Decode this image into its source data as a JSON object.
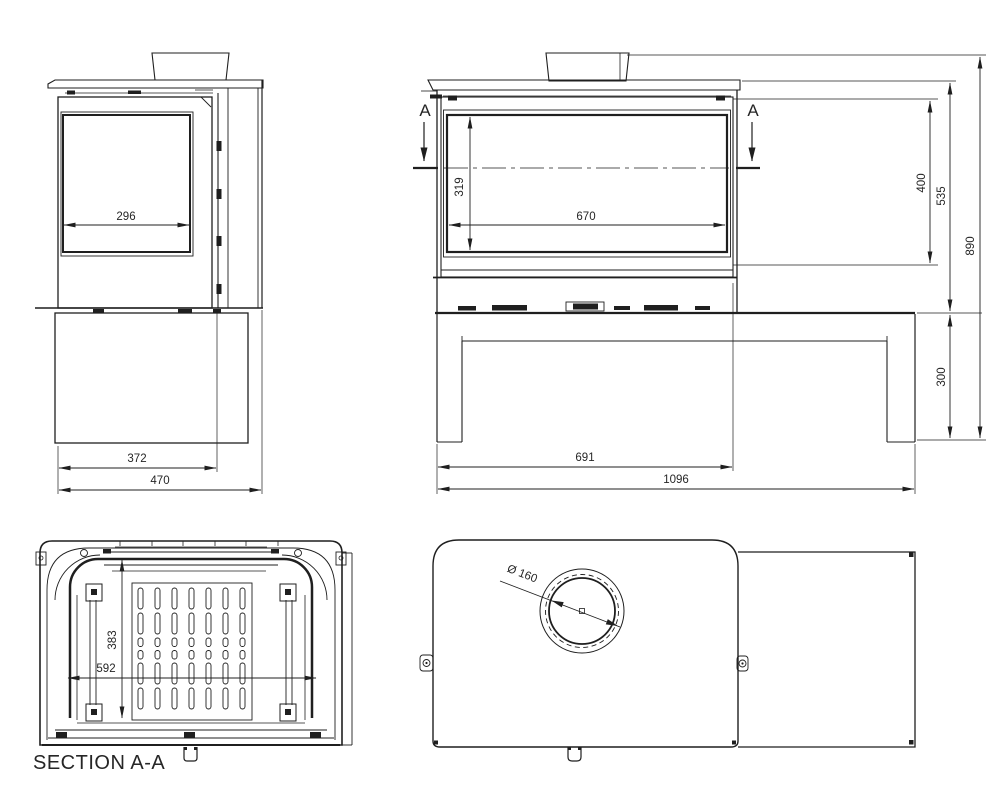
{
  "meta": {
    "background": "#ffffff",
    "ink": "#1f1f1f",
    "drawing_type": "stove technical drawing, 4 views"
  },
  "labels": {
    "section_marker": "A",
    "section_title": "SECTION A-A",
    "flue_diameter": "Ø 160"
  },
  "dimensions": {
    "side": {
      "glass_width": "296",
      "door_depth": "372",
      "total_depth": "470"
    },
    "front": {
      "glass_height": "319",
      "glass_width": "670",
      "firebox_height": "400",
      "stove_height": "535",
      "total_height": "890",
      "bench_height": "300",
      "stove_width": "691",
      "total_width": "1096"
    },
    "section": {
      "inner_depth": "383",
      "inner_width": "592"
    }
  }
}
